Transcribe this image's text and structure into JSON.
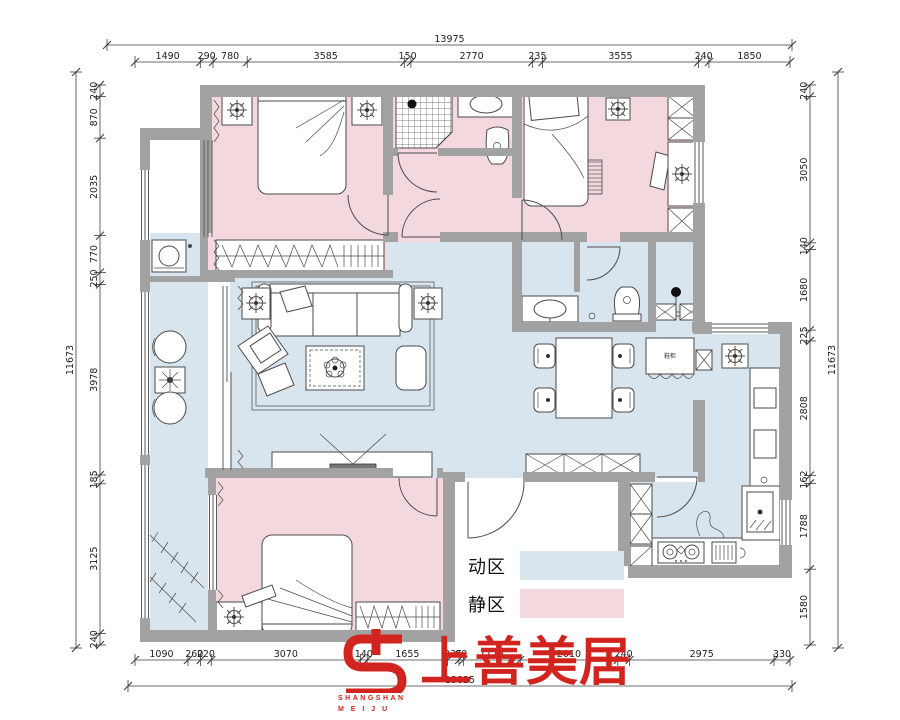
{
  "legend": {
    "items": [
      {
        "label": "动区",
        "meaning": "active zone",
        "color": "#d9e5ee"
      },
      {
        "label": "静区",
        "meaning": "quiet zone",
        "color": "#f3d9de"
      }
    ]
  },
  "logo": {
    "name_cn": "上善美居",
    "name_en_line1": "SHANGSHAN",
    "name_en_line2": "M E I J U",
    "color": "#d2241f"
  },
  "labels": {
    "entry_cabinet": "鞋柜"
  },
  "dimensions": {
    "top": {
      "overall": "13975",
      "segments": [
        "1490",
        "290",
        "780",
        "3585",
        "150",
        "2770",
        "235",
        "3555",
        "240",
        "1850"
      ]
    },
    "bottom": {
      "overall": "13825",
      "segments": [
        "1090",
        "260",
        "220",
        "3070",
        "140",
        "1655",
        "235",
        "90",
        "1170",
        "2010",
        "240",
        "2975",
        "330"
      ]
    },
    "left": {
      "overall": "11673",
      "segments": [
        "240",
        "870",
        "2035",
        "770",
        "250",
        "3978",
        "185",
        "3125",
        "240"
      ]
    },
    "right": {
      "overall": "11673",
      "segments": [
        "240",
        "3050",
        "140",
        "1680",
        "225",
        "2808",
        "162",
        "1788",
        "1580"
      ]
    }
  },
  "colors": {
    "active_zone": "#d9e5ee",
    "quiet_zone": "#f3d9de",
    "wall": "#a2a2a2",
    "logo_red": "#d2241f"
  }
}
